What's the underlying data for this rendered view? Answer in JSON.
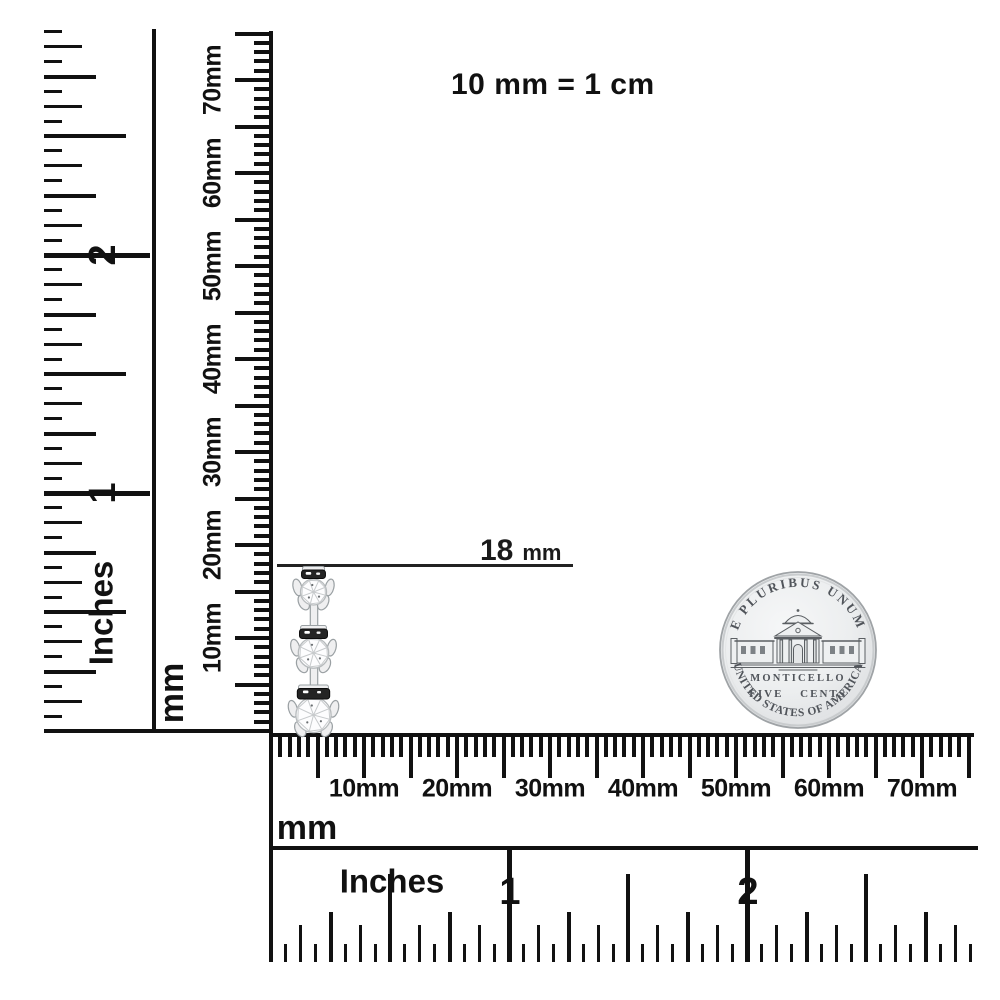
{
  "title": "10 mm = 1 cm",
  "annotation": {
    "value": "18",
    "unit": "mm"
  },
  "rulers": {
    "vertical_inches": {
      "unit": "Inches",
      "numbers": [
        "1",
        "2"
      ]
    },
    "vertical_mm": {
      "unit": "mm",
      "labels": [
        "10mm",
        "20mm",
        "30mm",
        "40mm",
        "50mm",
        "60mm",
        "70mm"
      ]
    },
    "horizontal_mm": {
      "unit": "mm",
      "labels": [
        "10mm",
        "20mm",
        "30mm",
        "40mm",
        "50mm",
        "60mm",
        "70mm"
      ]
    },
    "horizontal_inches": {
      "unit": "Inches",
      "numbers": [
        "1",
        "2"
      ]
    }
  },
  "coin": {
    "legend_top": "E PLURIBUS UNUM",
    "building_label": "MONTICELLO",
    "denomination": "FIVE CENTS",
    "legend_bottom": "UNITED STATES OF AMERICA"
  },
  "colors": {
    "ink": "#111111",
    "coin_face": "#e9ebec",
    "coin_edge": "#9fa3a6",
    "metal": "#efeff0"
  }
}
